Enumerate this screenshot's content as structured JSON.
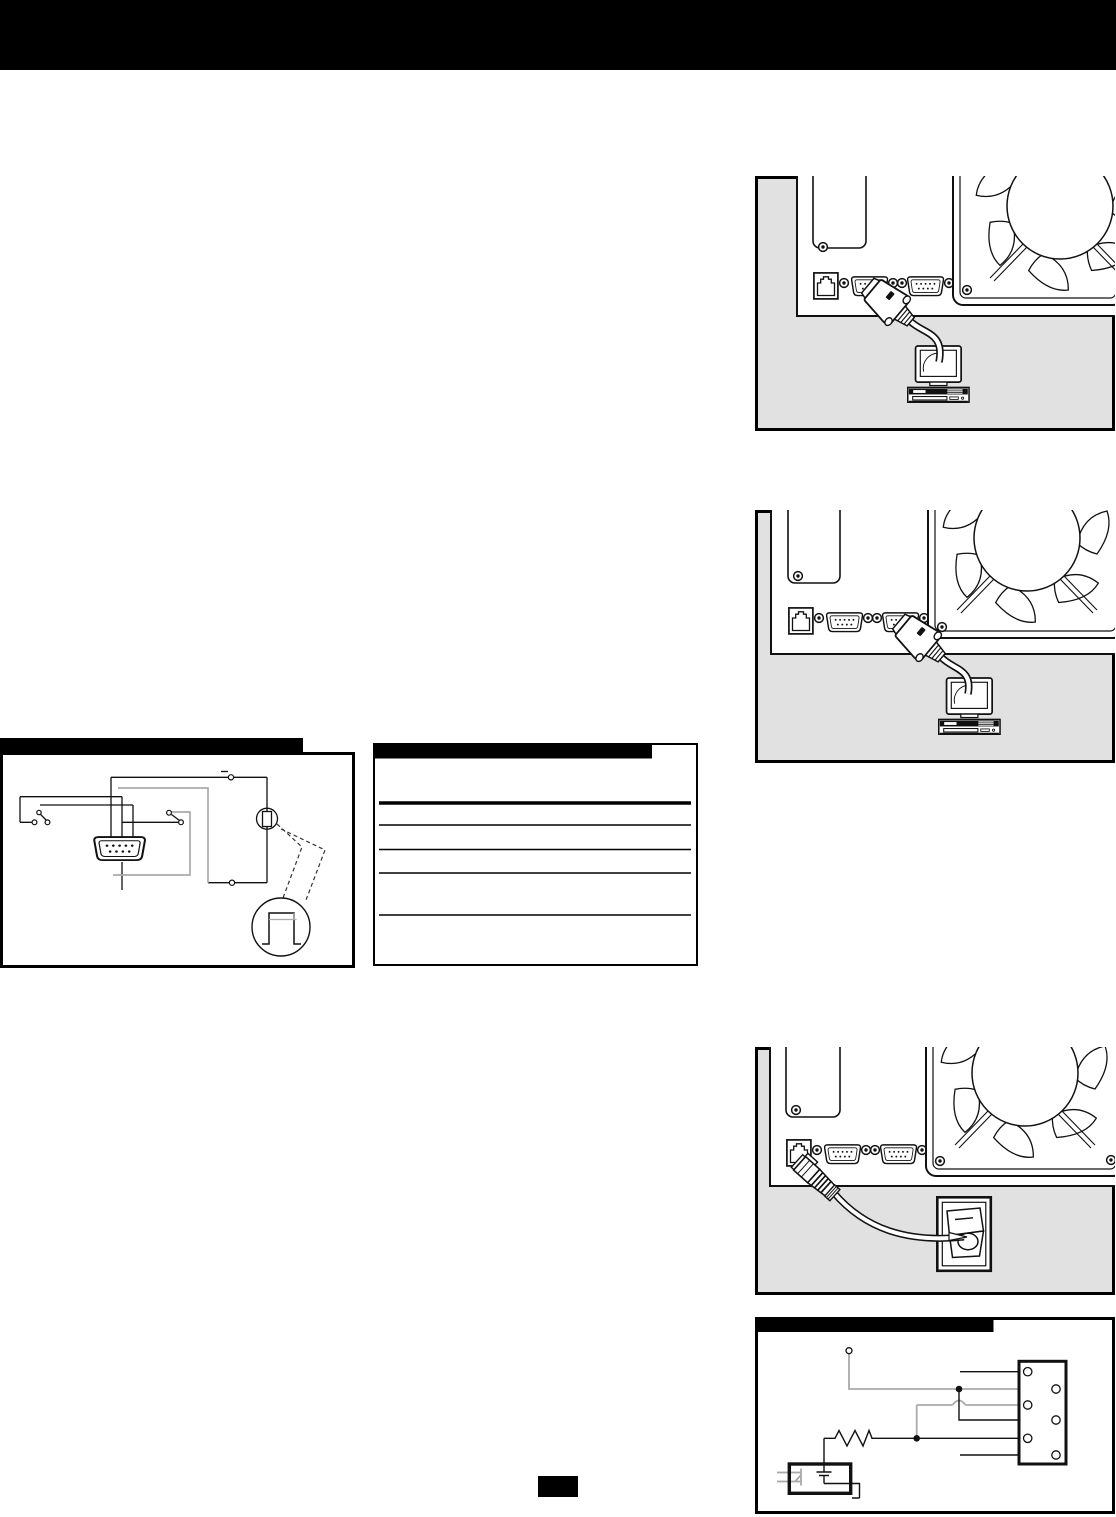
{
  "page": {
    "width": 1116,
    "height": 1517,
    "background": "#ffffff"
  },
  "top_banner": {
    "color": "#000000"
  },
  "palette": {
    "ink": "#111111",
    "figure_background": "#e1e1e1",
    "gray_wire": "#a9a9a9",
    "panel_white": "#ffffff",
    "header_bar": "#000000"
  },
  "figures": [
    {
      "id": "fig-serial-a",
      "label": "rear-panel-serial-port-1-cable-to-computer"
    },
    {
      "id": "fig-serial-b",
      "label": "rear-panel-serial-port-2-cable-to-computer"
    },
    {
      "id": "fig-wiring",
      "label": "db9-connector-switch-wiring-diagram"
    },
    {
      "id": "fig-table",
      "label": "blank-ruled-table-with-black-header"
    },
    {
      "id": "fig-remote",
      "label": "rear-panel-rj45-cable-to-rocker-switch"
    },
    {
      "id": "fig-schematic",
      "label": "terminal-block-optocoupler-schematic"
    }
  ],
  "page_marker": {
    "color": "#000000"
  }
}
